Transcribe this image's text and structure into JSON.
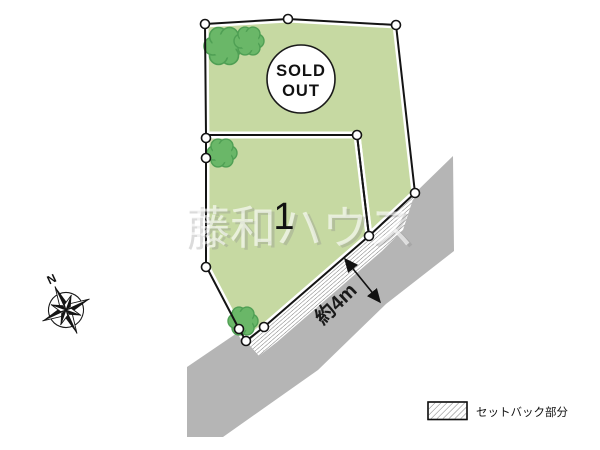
{
  "title": "land-plot-site-plan",
  "parcels": [
    {
      "name": "top-parcel",
      "status_label_line1": "SOLD",
      "status_label_line2": "OUT"
    },
    {
      "name": "parcel-1",
      "number": "1"
    }
  ],
  "road": {
    "width_label": "約4m"
  },
  "compass": {
    "north_label": "N"
  },
  "watermark": {
    "text": "藤和ハウス"
  },
  "legend": {
    "setback_label": "セットバック部分",
    "swatch": "diagonal-hatch"
  },
  "colors": {
    "parcel_green": "#c6d9a2",
    "tree_green": "#6ab768",
    "tree_outline": "#4f9f54",
    "road_gray": "#b5b5b5",
    "boundary_black": "#141414",
    "hatch_line_gray": "#6f6f6f",
    "marker_fill": "#ffffff"
  }
}
